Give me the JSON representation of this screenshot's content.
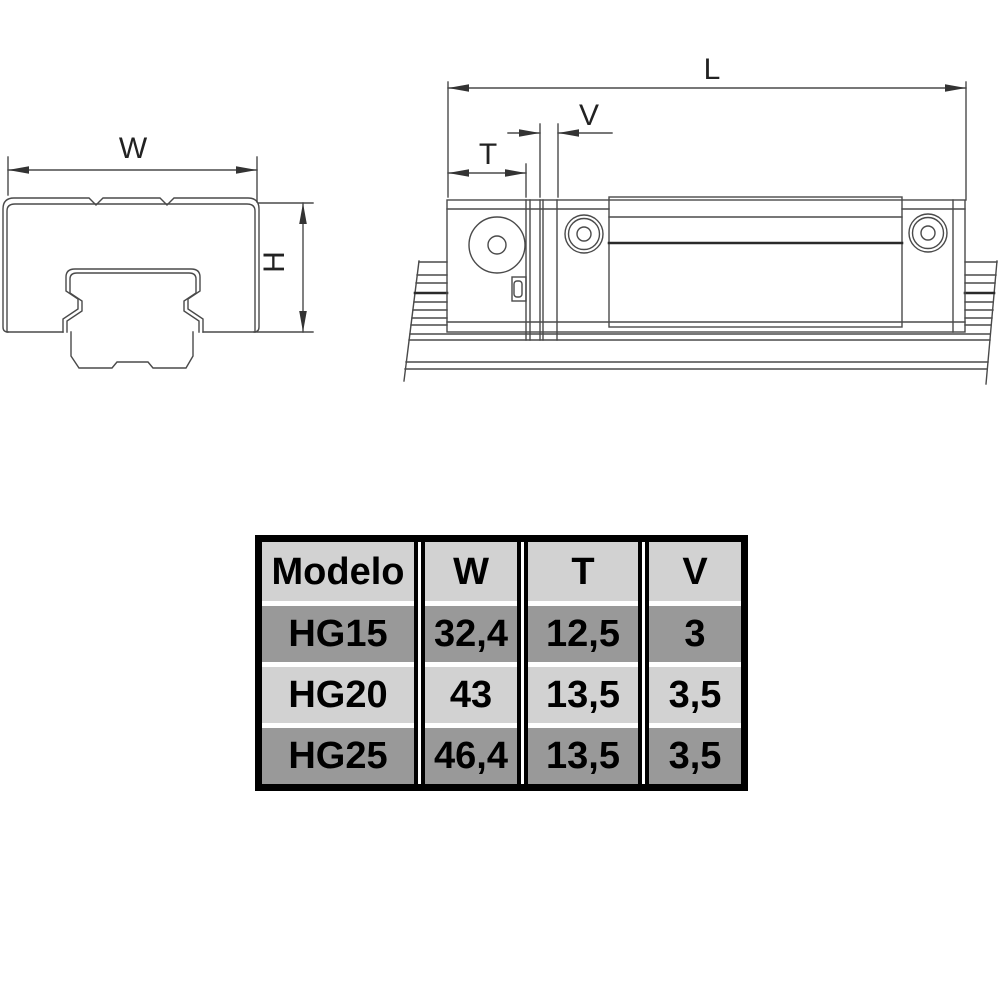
{
  "diagram": {
    "labels": {
      "w": "W",
      "h": "H",
      "l": "L",
      "t": "T",
      "v": "V"
    },
    "line_color": "#4a4a4a",
    "thick_line_color": "#2a2a2a",
    "background": "#ffffff"
  },
  "table": {
    "headers": [
      "Modelo",
      "W",
      "T",
      "V"
    ],
    "rows": [
      [
        "HG15",
        "32,4",
        "12,5",
        "3"
      ],
      [
        "HG20",
        "43",
        "13,5",
        "3,5"
      ],
      [
        "HG25",
        "46,4",
        "13,5",
        "3,5"
      ]
    ],
    "colors": {
      "header_bg": "#d2d2d2",
      "row_dark_bg": "#999999",
      "row_light_bg": "#d2d2d2",
      "border": "#000000",
      "text": "#000000"
    }
  }
}
